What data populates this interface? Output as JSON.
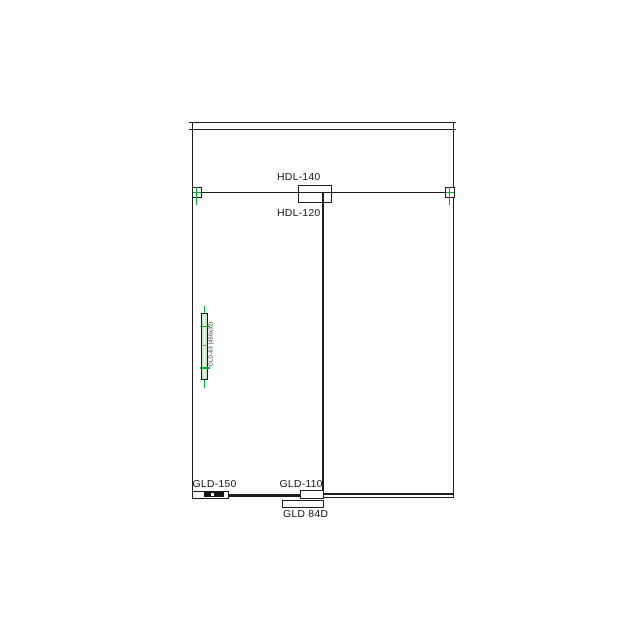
{
  "drawing": {
    "callouts": {
      "top_patch_upper": "HDL-140",
      "top_patch_lower": "HDL-120",
      "bottom_left_lock": "GLD-150",
      "bottom_center_patch": "GLD-110",
      "floor_closer": "GLD 84D",
      "pull_handle": "GLD-63 (450x32)"
    },
    "colors": {
      "line": "#1e1e1e",
      "marker_green": "#00ad2e",
      "handle_fill": "#c9efc9",
      "center_mark_red": "#ff5050",
      "background": "#ffffff"
    }
  }
}
